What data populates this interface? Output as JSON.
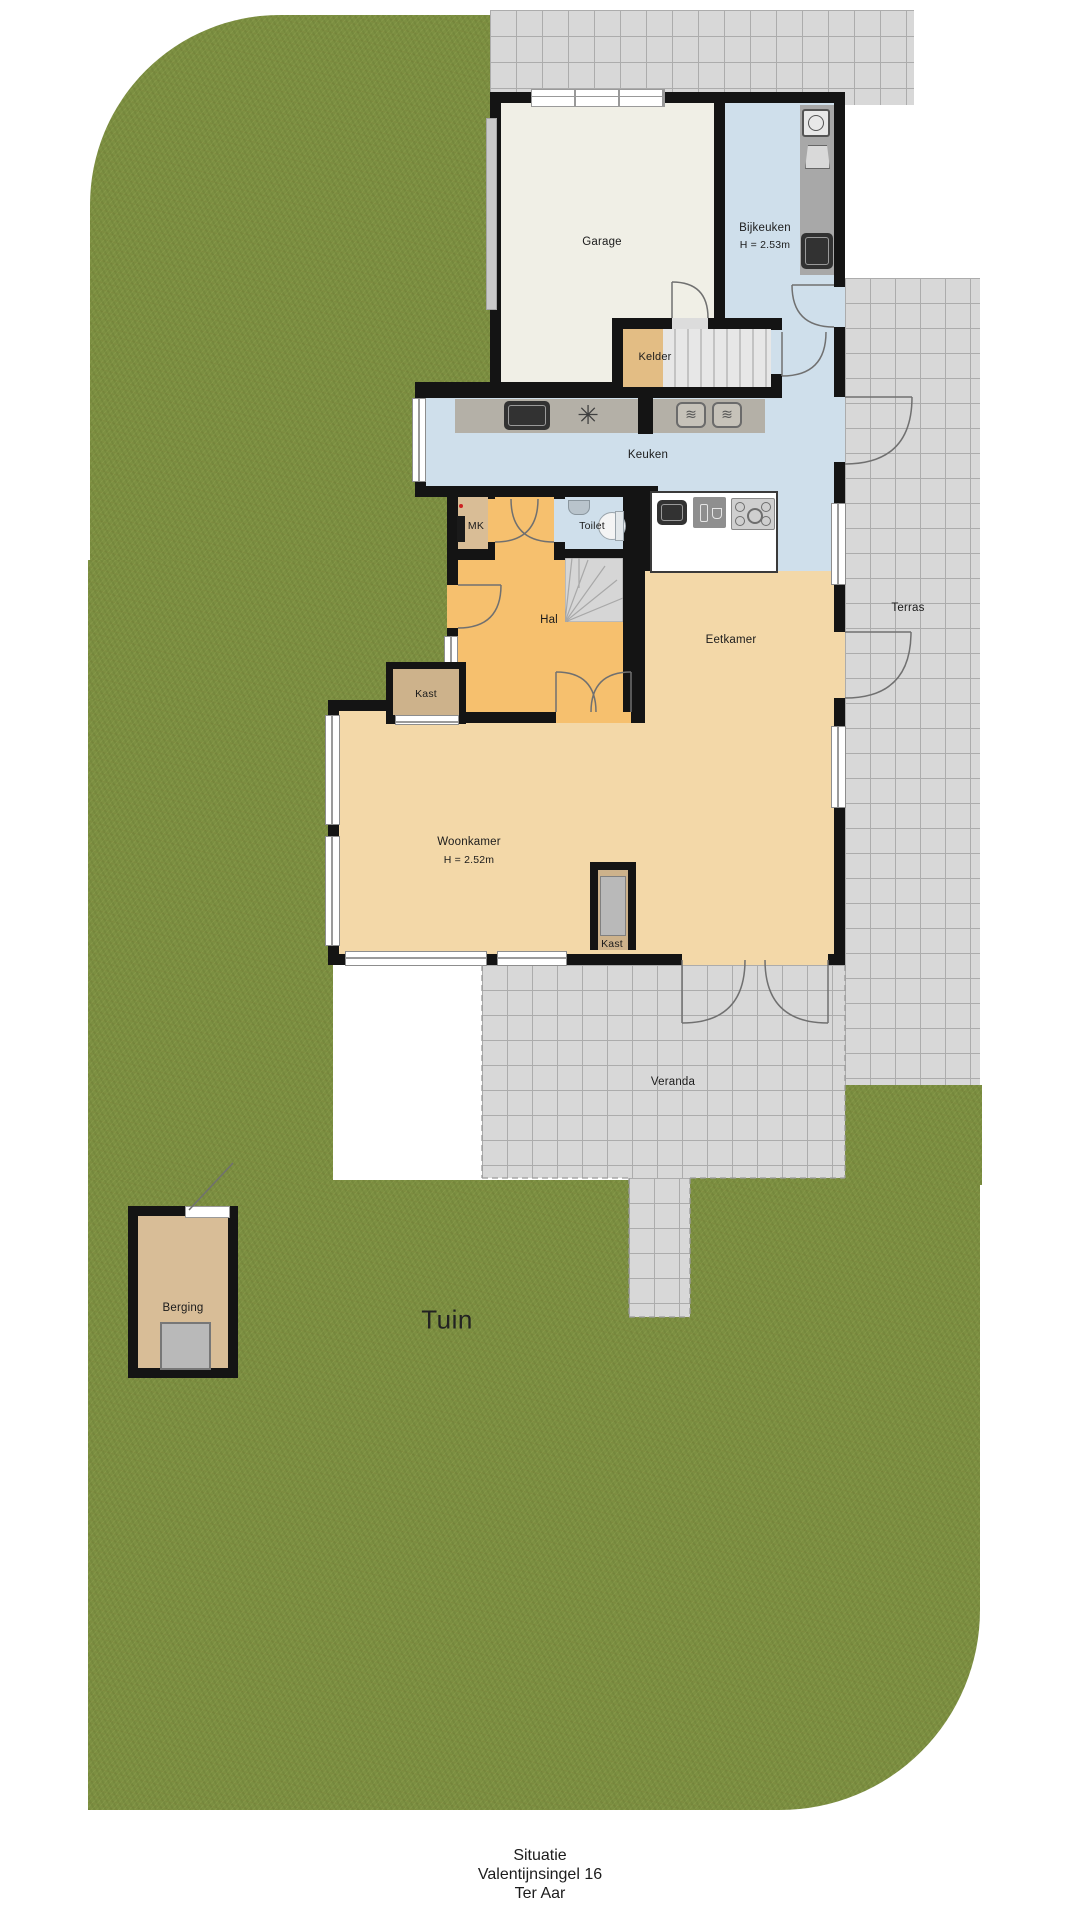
{
  "labels": {
    "garage": "Garage",
    "bijkeuken": "Bijkeuken",
    "bijkeuken_height": "H = 2.53m",
    "kelder": "Kelder",
    "keuken": "Keuken",
    "mk": "MK",
    "toilet": "Toilet",
    "hal": "Hal",
    "eetkamer": "Eetkamer",
    "woonkamer": "Woonkamer",
    "woonkamer_height": "H = 2.52m",
    "kast1": "Kast",
    "kast2": "Kast",
    "terras": "Terras",
    "veranda": "Veranda",
    "berging": "Berging",
    "tuin": "Tuin"
  },
  "footer": {
    "line1": "Situatie",
    "line2": "Valentijnsingel 16",
    "line3": "Ter Aar"
  },
  "icons": {
    "hob_flower": "✳",
    "oven_waves": "≋"
  },
  "colors": {
    "grass": "#7c8f41",
    "tile": "#d8d8d8",
    "tile_line": "#acacac",
    "wall": "#141414",
    "garage_floor": "#f0efe6",
    "wet_floor": "#cfdfeb",
    "hall_floor": "#f6c06e",
    "living_floor": "#f3d8a8",
    "closet_floor": "#cdb28b",
    "stairs": "#d8d8d8"
  }
}
